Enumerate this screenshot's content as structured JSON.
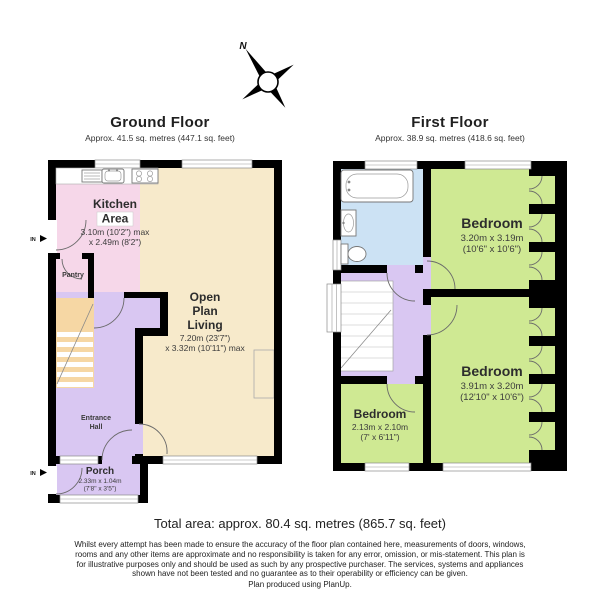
{
  "colors": {
    "wall": "#000000",
    "kitchen": "#F6D7E9",
    "living": "#F7EACB",
    "hall": "#D9C7F2",
    "stairs": "#F6D7A4",
    "bedroom": "#CFE993",
    "bathroom": "#CCE2F4"
  },
  "compass": {
    "north_label": "N"
  },
  "gf": {
    "title": "Ground Floor",
    "subtitle": "Approx. 41.5 sq. metres (447.1 sq. feet)",
    "kitchen": {
      "line1": "Kitchen",
      "line2": "Area",
      "dim1": "3.10m (10'2\") max",
      "dim2": "x 2.49m (8'2\")"
    },
    "pantry": {
      "name": "Pantry"
    },
    "living": {
      "line1": "Open",
      "line2": "Plan",
      "line3": "Living",
      "dim1": "7.20m (23'7\")",
      "dim2": "x 3.32m (10'11\") max"
    },
    "hall": {
      "line1": "Entrance",
      "line2": "Hall"
    },
    "porch": {
      "name": "Porch",
      "dim1": "2.33m x 1.04m",
      "dim2": "(7'8\" x 3'5\")"
    },
    "entry_label": "IN"
  },
  "ff": {
    "title": "First Floor",
    "subtitle": "Approx. 38.9 sq. metres (418.6 sq. feet)",
    "bedroom1": {
      "name": "Bedroom",
      "dim1": "3.20m x 3.19m",
      "dim2": "(10'6\" x 10'6\")"
    },
    "bedroom2": {
      "name": "Bedroom",
      "dim1": "3.91m x 3.20m",
      "dim2": "(12'10\" x 10'6\")"
    },
    "bedroom3": {
      "name": "Bedroom",
      "dim1": "2.13m x 2.10m",
      "dim2": "(7' x 6'11\")"
    }
  },
  "footer": {
    "total": "Total area: approx. 80.4 sq. metres (865.7 sq. feet)",
    "disclaimer": "Whilst every attempt has been made to ensure the accuracy of the floor plan contained here, measurements of doors, windows, rooms and any other items are approximate and no responsibility is taken for any error, omission, or mis-statement. This plan is for illustrative purposes only and should be used as such by any prospective purchaser. The services, systems and appliances shown have not been tested and no guarantee as to their operability or efficiency can be given.",
    "credit": "Plan produced using PlanUp."
  }
}
